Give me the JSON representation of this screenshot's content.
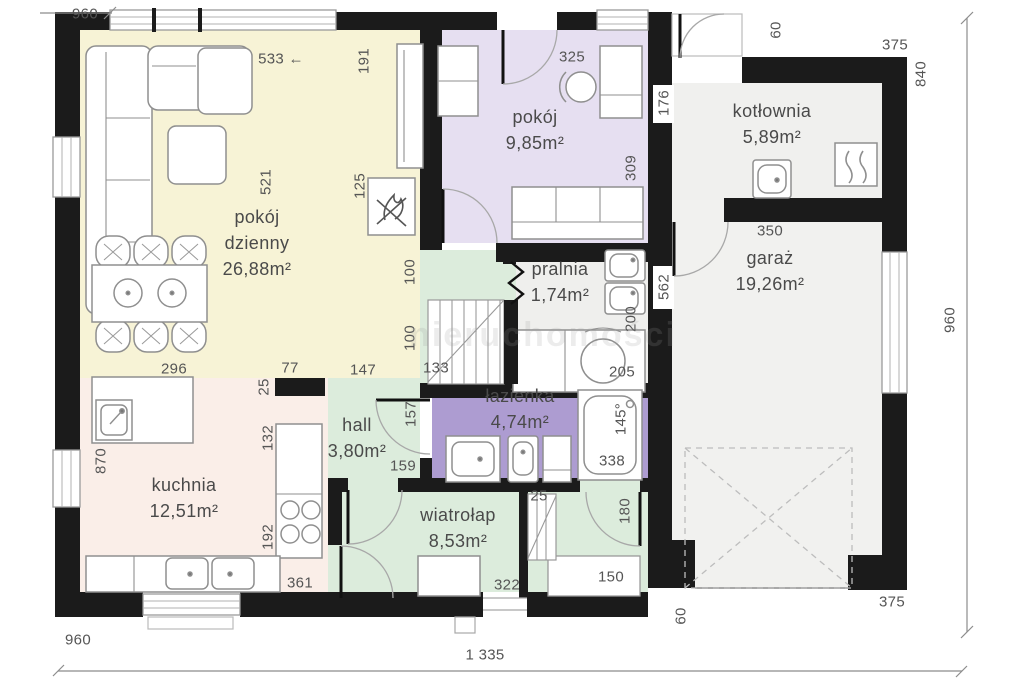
{
  "watermark": {
    "text": "nieruchomości"
  },
  "colors": {
    "wall": "#1b1b1b",
    "living_yellow": "#f7f3d6",
    "bedroom_lavender": "#e6dff1",
    "bathroom_purple": "#ad9cd1",
    "green_mint": "#dcecdc",
    "kitchen_pink": "#faeee8",
    "utility_gray": "#f0f0ee",
    "label_text": "#4a4a4a",
    "dim_text": "#555555"
  },
  "rooms": [
    {
      "name": "pokój dzienny",
      "area": "26,88m²"
    },
    {
      "name": "pokój",
      "area": "9,85m²"
    },
    {
      "name": "kotłownia",
      "area": "5,89m²"
    },
    {
      "name": "garaż",
      "area": "19,26m²"
    },
    {
      "name": "pralnia",
      "area": "1,74m²"
    },
    {
      "name": "łazienka",
      "area": "4,74m²"
    },
    {
      "name": "hall",
      "area": "3,80m²"
    },
    {
      "name": "kuchnia",
      "area": "12,51m²"
    },
    {
      "name": "wiatrołap",
      "area": "8,53m²"
    }
  ],
  "room_labels": [
    {
      "lines": [
        "pokój",
        "dzienny",
        "26,88m²"
      ],
      "x": 257,
      "y": 204
    },
    {
      "lines": [
        "pokój",
        "9,85m²"
      ],
      "x": 535,
      "y": 104
    },
    {
      "lines": [
        "kotłownia",
        "5,89m²"
      ],
      "x": 772,
      "y": 98
    },
    {
      "lines": [
        "garaż",
        "19,26m²"
      ],
      "x": 770,
      "y": 245
    },
    {
      "lines": [
        "pralnia",
        "1,74m²"
      ],
      "x": 560,
      "y": 256
    },
    {
      "lines": [
        "łazienka",
        "4,74m²"
      ],
      "x": 520,
      "y": 383
    },
    {
      "lines": [
        "hall",
        "3,80m²"
      ],
      "x": 357,
      "y": 412
    },
    {
      "lines": [
        "kuchnia",
        "12,51m²"
      ],
      "x": 184,
      "y": 472
    },
    {
      "lines": [
        "wiatrołap",
        "8,53m²"
      ],
      "x": 458,
      "y": 502
    }
  ],
  "dimension_labels": [
    {
      "text": "960",
      "x": 85,
      "y": 14
    },
    {
      "text": "533 ←",
      "x": 281,
      "y": 59
    },
    {
      "text": "191",
      "x": 364,
      "y": 61,
      "rot": true
    },
    {
      "text": "521",
      "x": 266,
      "y": 182,
      "rot": true
    },
    {
      "text": "125",
      "x": 360,
      "y": 186,
      "rot": true
    },
    {
      "text": "296",
      "x": 174,
      "y": 369
    },
    {
      "text": "77",
      "x": 290,
      "y": 368
    },
    {
      "text": "25",
      "x": 264,
      "y": 387,
      "rot": true
    },
    {
      "text": "147",
      "x": 363,
      "y": 370
    },
    {
      "text": "100",
      "x": 410,
      "y": 272,
      "rot": true
    },
    {
      "text": "100",
      "x": 410,
      "y": 338,
      "rot": true
    },
    {
      "text": "133",
      "x": 436,
      "y": 368
    },
    {
      "text": "870",
      "x": 101,
      "y": 461,
      "rot": true
    },
    {
      "text": "132",
      "x": 268,
      "y": 438,
      "rot": true
    },
    {
      "text": "192",
      "x": 268,
      "y": 537,
      "rot": true
    },
    {
      "text": "361",
      "x": 300,
      "y": 583
    },
    {
      "text": "322",
      "x": 507,
      "y": 585
    },
    {
      "text": "25",
      "x": 539,
      "y": 496
    },
    {
      "text": "180",
      "x": 625,
      "y": 511,
      "rot": true
    },
    {
      "text": "150",
      "x": 611,
      "y": 577
    },
    {
      "text": "157",
      "x": 411,
      "y": 414,
      "rot": true
    },
    {
      "text": "159",
      "x": 403,
      "y": 466
    },
    {
      "text": "145°",
      "x": 621,
      "y": 419,
      "rot": true
    },
    {
      "text": "338",
      "x": 612,
      "y": 461
    },
    {
      "text": "200",
      "x": 631,
      "y": 319,
      "rot": true
    },
    {
      "text": "205",
      "x": 622,
      "y": 372
    },
    {
      "text": "325",
      "x": 572,
      "y": 57
    },
    {
      "text": "309",
      "x": 631,
      "y": 168,
      "rot": true
    },
    {
      "text": "176",
      "x": 664,
      "y": 103,
      "rot": true
    },
    {
      "text": "60",
      "x": 776,
      "y": 30,
      "rot": true
    },
    {
      "text": "375",
      "x": 895,
      "y": 45
    },
    {
      "text": "840",
      "x": 921,
      "y": 74,
      "rot": true
    },
    {
      "text": "350",
      "x": 770,
      "y": 231
    },
    {
      "text": "562",
      "x": 664,
      "y": 287,
      "rot": true
    },
    {
      "text": "960",
      "x": 950,
      "y": 320,
      "rot": true
    },
    {
      "text": "375",
      "x": 892,
      "y": 602
    },
    {
      "text": "60",
      "x": 681,
      "y": 616,
      "rot": true
    },
    {
      "text": "960",
      "x": 78,
      "y": 640
    },
    {
      "text": "1 335",
      "x": 485,
      "y": 655
    }
  ]
}
